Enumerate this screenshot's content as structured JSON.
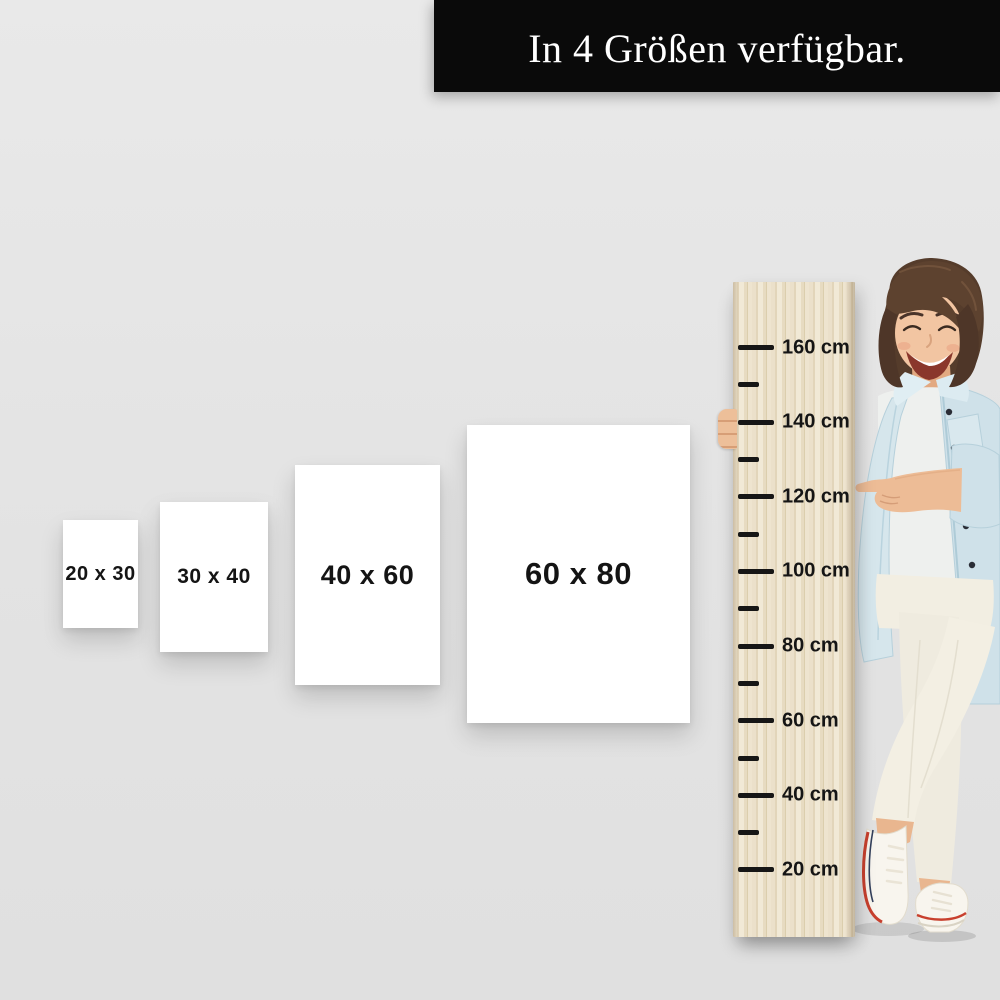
{
  "banner": {
    "text": "In 4 Größen verfügbar."
  },
  "size_options": [
    {
      "label": "20 x 30",
      "width_cm": 20,
      "height_cm": 30
    },
    {
      "label": "30 x 40",
      "width_cm": 30,
      "height_cm": 40
    },
    {
      "label": "40 x 60",
      "width_cm": 40,
      "height_cm": 60
    },
    {
      "label": "60 x 80",
      "width_cm": 60,
      "height_cm": 80
    }
  ],
  "ruler": {
    "unit": "cm",
    "ticks": [
      {
        "cm": 160,
        "label": "160 cm"
      },
      {
        "cm": 150
      },
      {
        "cm": 140,
        "label": "140 cm"
      },
      {
        "cm": 130
      },
      {
        "cm": 120,
        "label": "120 cm"
      },
      {
        "cm": 110
      },
      {
        "cm": 100,
        "label": "100 cm"
      },
      {
        "cm": 90
      },
      {
        "cm": 80,
        "label": "80 cm"
      },
      {
        "cm": 70
      },
      {
        "cm": 60,
        "label": "60 cm"
      },
      {
        "cm": 50
      },
      {
        "cm": 40,
        "label": "40 cm"
      },
      {
        "cm": 30
      },
      {
        "cm": 20,
        "label": "20 cm"
      }
    ]
  },
  "colors": {
    "background": "#e3e3e3",
    "banner_bg": "#0a0a0a",
    "banner_text": "#ffffff",
    "poster_bg": "#ffffff",
    "poster_text": "#141414",
    "wood_base": "#e9ddc4",
    "tick": "#161616",
    "denim": "#cfe1e9",
    "shoe_red": "#c8402e",
    "shoe_navy": "#33405c"
  }
}
